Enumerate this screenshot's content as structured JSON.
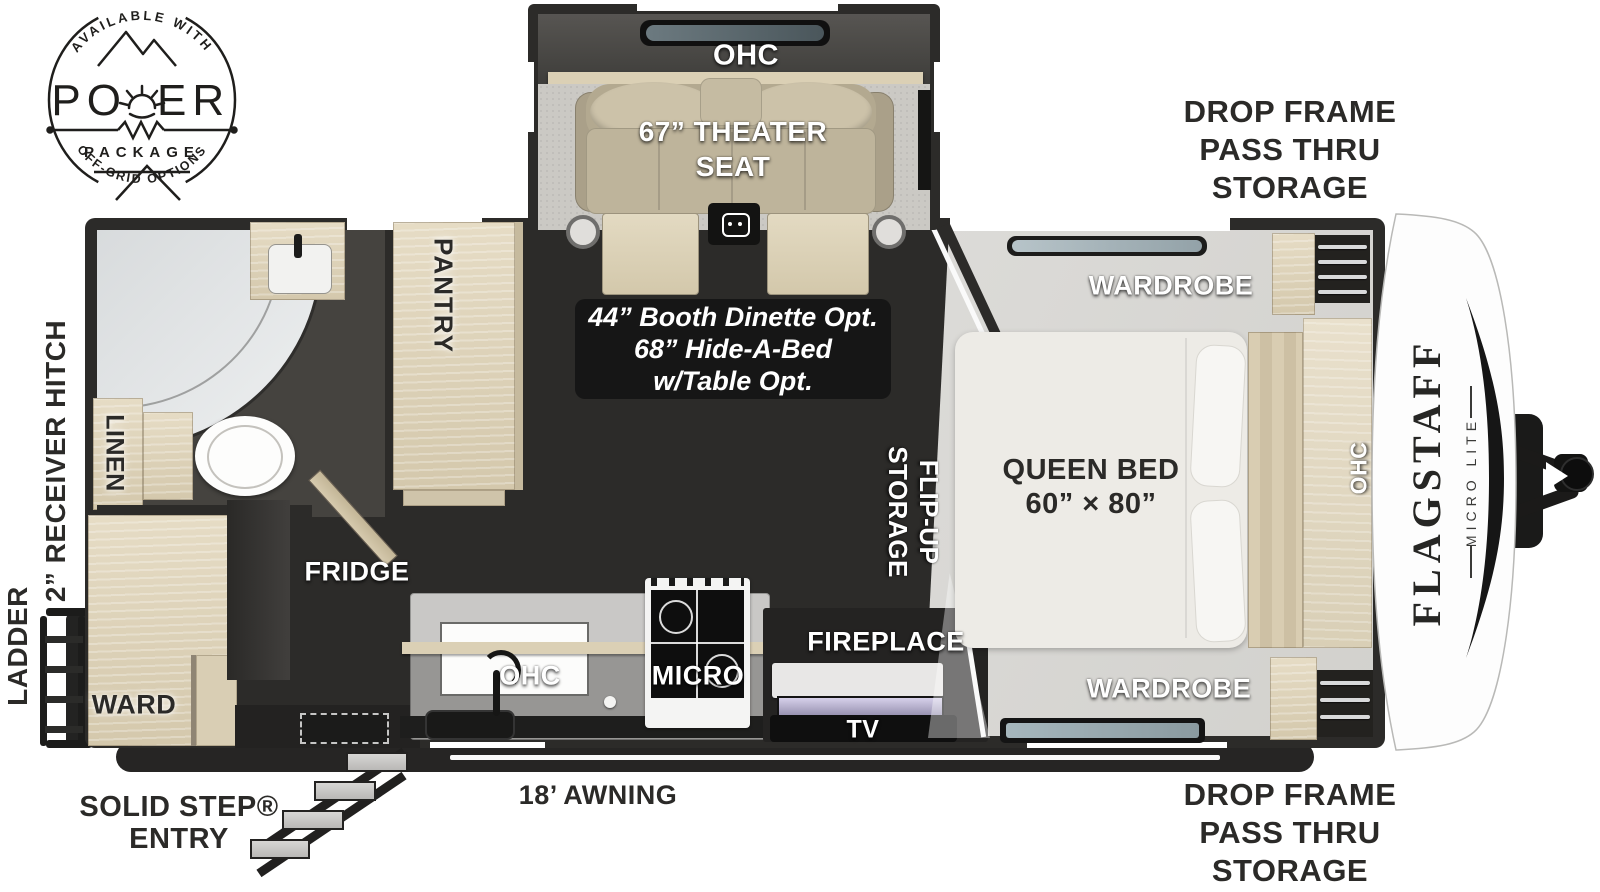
{
  "badge": {
    "arc_top": "AVAILABLE WITH",
    "word_left": "PO",
    "word_right": "ER",
    "subtitle": "PACKAGE",
    "arc_bottom": "OFF-GRID OPTIONS"
  },
  "branding": {
    "name": "FLAGSTAFF",
    "series": "MICRO LITE"
  },
  "slide_out": {
    "ohc": "OHC",
    "theater_line1": "67” THEATER",
    "theater_line2": "SEAT"
  },
  "options_box": {
    "line1": "44” Booth Dinette Opt.",
    "line2": "68” Hide-A-Bed",
    "line3": "w/Table Opt."
  },
  "interior": {
    "pantry": "PANTRY",
    "linen": "LINEN",
    "fridge": "FRIDGE",
    "ward": "WARD",
    "kitchen_ohc": "OHC",
    "micro": "MICRO",
    "fireplace": "FIREPLACE",
    "tv": "TV",
    "flip_up_line1": "FLIP-UP",
    "flip_up_line2": "STORAGE",
    "queen_bed_line1": "QUEEN BED",
    "queen_bed_line2": "60” × 80”",
    "wardrobe_top": "WARDROBE",
    "wardrobe_bottom": "WARDROBE",
    "bed_ohc": "OHC"
  },
  "exterior": {
    "drop_frame_top": [
      "DROP FRAME",
      "PASS THRU",
      "STORAGE"
    ],
    "drop_frame_bottom": [
      "DROP FRAME",
      "PASS THRU",
      "STORAGE"
    ],
    "receiver_hitch": "2” RECEIVER HITCH",
    "ladder": "LADDER",
    "solid_step_line1": "SOLID STEP®",
    "solid_step_line2": "ENTRY",
    "awning": "18’ AWNING"
  },
  "colors": {
    "wall": "#2c2b29",
    "floor_wood": "#a7a5a1",
    "floor_bedroom": "#d8d6d2",
    "cabinet_wood": "#ddd2b8",
    "seat_tan": "#c2b89f",
    "label_white": "#ffffff",
    "label_dark": "#2b2a28",
    "options_box_bg": "#161616"
  }
}
